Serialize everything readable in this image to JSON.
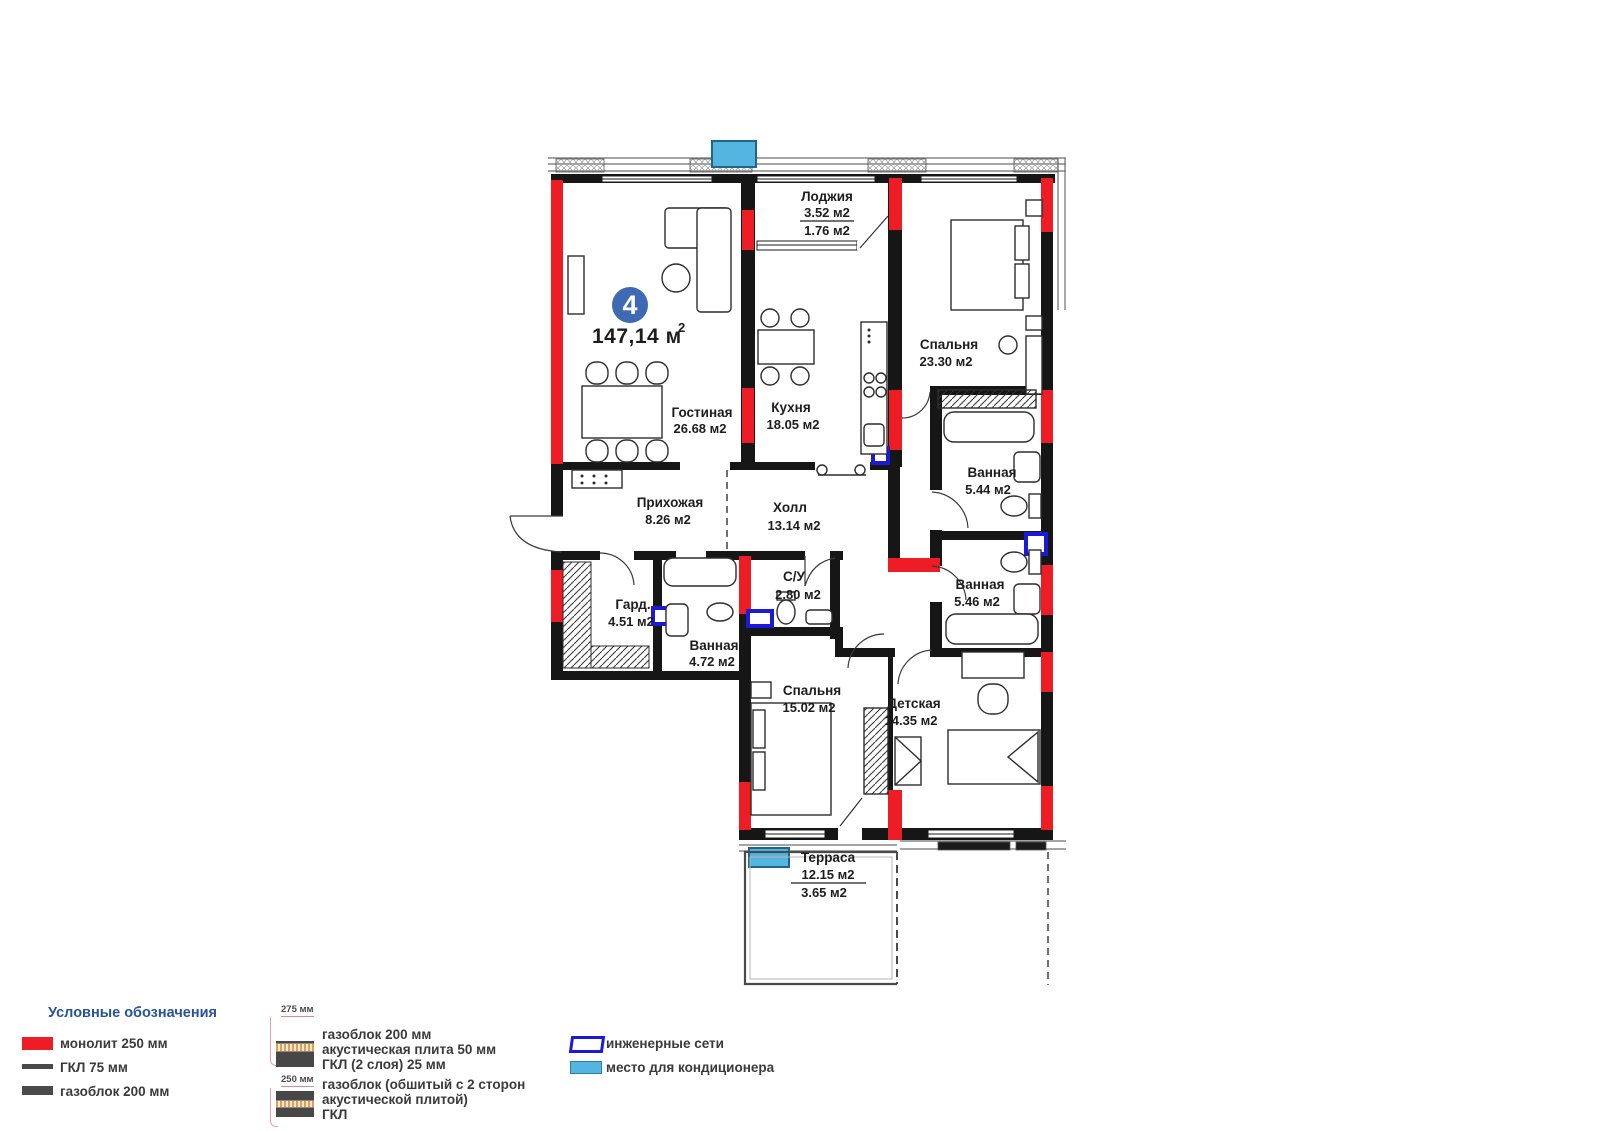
{
  "plan": {
    "unit_badge": "4",
    "total_area": "147,14 м",
    "total_area_sup": "2",
    "rooms": [
      {
        "name": "Лоджия",
        "area": "3.52 м2",
        "area_secondary": "1.76 м2"
      },
      {
        "name": "Спальня",
        "area": "23.30 м2"
      },
      {
        "name": "Гостиная",
        "area": "26.68 м2"
      },
      {
        "name": "Кухня",
        "area": "18.05 м2"
      },
      {
        "name": "Прихожая",
        "area": "8.26 м2"
      },
      {
        "name": "Холл",
        "area": "13.14 м2"
      },
      {
        "name": "Ванная",
        "area": "5.44 м2"
      },
      {
        "name": "Ванная",
        "area": "5.46 м2"
      },
      {
        "name": "Гард.",
        "area": "4.51 м2"
      },
      {
        "name": "Ванная",
        "area": "4.72 м2"
      },
      {
        "name": "С/У",
        "area": "2.80 м2"
      },
      {
        "name": "Спальня",
        "area": "15.02 м2"
      },
      {
        "name": "Детская",
        "area": "14.35 м2"
      },
      {
        "name": "Терраса",
        "area": "12.15 м2",
        "area_secondary": "3.65 м2"
      }
    ]
  },
  "legend": {
    "title": "Условные обозначения",
    "wall_types": [
      {
        "label": "монолит 250 мм"
      },
      {
        "label": "ГКЛ 75 мм"
      },
      {
        "label": "газоблок 200 мм"
      }
    ],
    "layered_types": [
      {
        "thickness": "275 мм",
        "lines": [
          "газоблок 200 мм",
          "акустическая плита 50 мм",
          "ГКЛ (2 слоя) 25 мм"
        ]
      },
      {
        "thickness": "250 мм",
        "lines": [
          "газоблок (обшитый с 2 сторон",
          "акустической плитой)",
          "ГКЛ"
        ]
      }
    ],
    "markers": [
      {
        "label": "инженерные сети"
      },
      {
        "label": "место для кондиционера"
      }
    ]
  },
  "colors": {
    "monolith_red": "#EE1C25",
    "engineering_blue": "#1A1AD8",
    "ac_blue": "#54B5E1",
    "badge_blue": "#3D6AB3",
    "legend_title_blue": "#27539E",
    "wall_black": "#161616"
  }
}
